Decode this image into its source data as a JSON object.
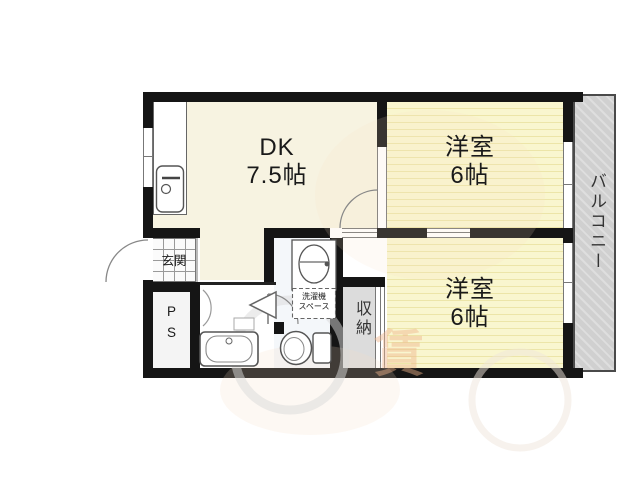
{
  "floorplan": {
    "colors": {
      "wall": "#151515",
      "tatami": "#f9f6cf",
      "tatami_stripe": "#ece5a8",
      "dk_floor": "#f7f3e1",
      "bath_tile": "#b5d4eb",
      "balcony_gray": "#d0d0d0",
      "storage_gray": "#dcdcdc",
      "watermark_orange": "#f0b58c"
    },
    "dk": {
      "name": "DK",
      "size": "7.5帖"
    },
    "bedroom_top": {
      "name": "洋室",
      "size": "6帖"
    },
    "bedroom_bottom": {
      "name": "洋室",
      "size": "6帖"
    },
    "balcony": {
      "name": "バルコニー"
    },
    "entrance": {
      "name": "玄関"
    },
    "pipe_space": {
      "line1": "P",
      "line2": "S"
    },
    "storage": {
      "name": "収納"
    },
    "laundry_space": {
      "line1": "洗濯機",
      "line2": "スペース"
    },
    "watermark": {
      "text": "賃"
    }
  }
}
